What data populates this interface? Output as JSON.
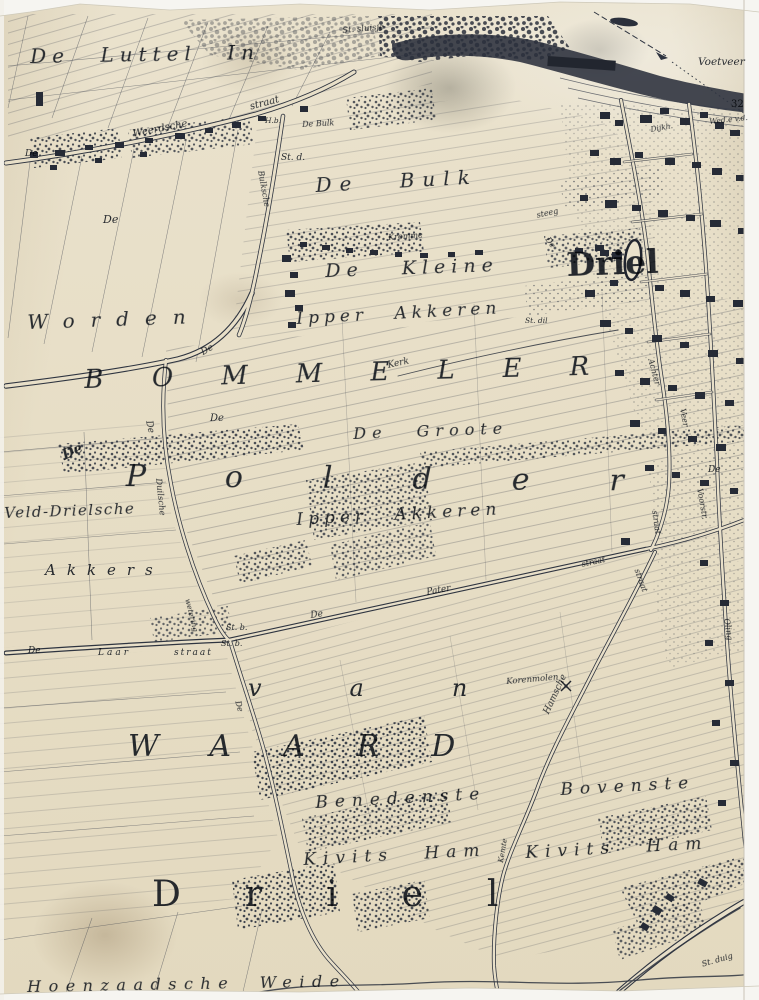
{
  "map": {
    "type": "historical-cadastral-map",
    "colors": {
      "paper": "#e8dfc8",
      "ink": "#2e3440",
      "frame": "#f6f5f1"
    },
    "labels": [
      {
        "id": "de-luttel-in",
        "t": "De Luttel In",
        "x": 30,
        "y": 46,
        "s": 20,
        "ls": 6,
        "ws": 18,
        "rot": -1
      },
      {
        "id": "st-sluisje",
        "t": "St. sluisje",
        "x": 342,
        "y": 27,
        "s": 8.5,
        "rot": -5
      },
      {
        "id": "voetveer",
        "t": "Voetveer",
        "x": 698,
        "y": 57,
        "s": 10.5
      },
      {
        "id": "peil-32",
        "t": "32",
        "x": 731,
        "y": 100,
        "s": 10,
        "cls": "upright"
      },
      {
        "id": "wed-vd",
        "t": "Wed.e v.d.",
        "x": 709,
        "y": 118,
        "s": 7.5,
        "rot": -6
      },
      {
        "id": "dijkh",
        "t": "Dijkh.",
        "x": 650,
        "y": 126,
        "s": 7.5,
        "rot": -10
      },
      {
        "id": "de-topleft",
        "t": "De",
        "x": 25,
        "y": 150,
        "s": 9
      },
      {
        "id": "weerdsche",
        "t": "Weerdsche",
        "x": 132,
        "y": 130,
        "s": 10,
        "rot": -11
      },
      {
        "id": "straat-top",
        "t": "straat",
        "x": 249,
        "y": 103,
        "s": 10,
        "rot": -15
      },
      {
        "id": "h-b",
        "t": "H.b.",
        "x": 265,
        "y": 117,
        "s": 7.5
      },
      {
        "id": "de-bulk-farm",
        "t": "De Bulk",
        "x": 302,
        "y": 121,
        "s": 8,
        "rot": -3
      },
      {
        "id": "st-d",
        "t": "St. d.",
        "x": 281,
        "y": 154,
        "s": 9
      },
      {
        "id": "bulksche-road",
        "t": "Bulksche",
        "x": 264,
        "y": 170,
        "s": 8,
        "rot": 80
      },
      {
        "id": "de-bulk",
        "t": "De Bulk",
        "x": 315,
        "y": 175,
        "s": 20,
        "ls": 8,
        "ws": 26,
        "rot": -3
      },
      {
        "id": "steeg",
        "t": "steeg",
        "x": 536,
        "y": 212,
        "s": 8,
        "rot": -12
      },
      {
        "id": "kromme",
        "t": "Kromme",
        "x": 388,
        "y": 234,
        "s": 8,
        "rot": -4
      },
      {
        "id": "de-road-driel",
        "t": "De",
        "x": 550,
        "y": 236,
        "s": 8,
        "rot": 55
      },
      {
        "id": "driel-town",
        "t": "Driel",
        "x": 566,
        "y": 248,
        "s": 33,
        "cls": "heavy",
        "rot": -2
      },
      {
        "id": "de-kleine",
        "t": "De Kleine",
        "x": 325,
        "y": 262,
        "s": 19,
        "ls": 6,
        "ws": 26,
        "rot": -2
      },
      {
        "id": "de-worden",
        "t": "De",
        "x": 103,
        "y": 214,
        "s": 11
      },
      {
        "id": "worden",
        "t": "Worden",
        "x": 27,
        "y": 312,
        "s": 20,
        "ls": 16,
        "rot": -2
      },
      {
        "id": "ipper-akkeren-1",
        "t": "Ipper Akkeren",
        "x": 296,
        "y": 311,
        "s": 17,
        "ls": 5,
        "ws": 16,
        "rot": -3
      },
      {
        "id": "st-dil",
        "t": "St. dil",
        "x": 525,
        "y": 317,
        "s": 7.5
      },
      {
        "id": "kerk-road",
        "t": "Kerk",
        "x": 387,
        "y": 362,
        "s": 9,
        "rot": -12
      },
      {
        "id": "bommeler",
        "t": "BOMMELER",
        "x": 84,
        "y": 367,
        "s": 26,
        "ls": 48,
        "rot": -1.5
      },
      {
        "id": "de-dike",
        "t": "De",
        "x": 200,
        "y": 350,
        "s": 9,
        "rot": -30
      },
      {
        "id": "de-small-1",
        "t": "De",
        "x": 210,
        "y": 414,
        "s": 10
      },
      {
        "id": "de-vert-1",
        "t": "De",
        "x": 152,
        "y": 420,
        "s": 9,
        "rot": 78
      },
      {
        "id": "de-groote",
        "t": "De Groote",
        "x": 353,
        "y": 426,
        "s": 16,
        "ls": 6,
        "ws": 18,
        "rot": -2
      },
      {
        "id": "de-polder",
        "t": "De",
        "x": 60,
        "y": 450,
        "s": 14,
        "rot": -25,
        "cls": "bold"
      },
      {
        "id": "polder",
        "t": "Polder",
        "x": 126,
        "y": 462,
        "s": 30,
        "ls": 80,
        "rot": 0.5
      },
      {
        "id": "de-voorn",
        "t": "De",
        "x": 708,
        "y": 466,
        "s": 9
      },
      {
        "id": "voorstr",
        "t": "Voorstr.",
        "x": 703,
        "y": 488,
        "s": 8,
        "rot": 80
      },
      {
        "id": "veld-drielsche",
        "t": "Veld-Drielsche",
        "x": 4,
        "y": 506,
        "s": 15,
        "ls": 1.5,
        "rot": -2
      },
      {
        "id": "duilsche-road",
        "t": "Duilsche",
        "x": 162,
        "y": 478,
        "s": 8.5,
        "rot": 84
      },
      {
        "id": "ipper-akkeren-2",
        "t": "Ipper Akkeren",
        "x": 296,
        "y": 512,
        "s": 17,
        "ls": 5,
        "ws": 16,
        "rot": -3
      },
      {
        "id": "akkers",
        "t": "Akkers",
        "x": 45,
        "y": 563,
        "s": 15,
        "ls": 11
      },
      {
        "id": "straat-mid",
        "t": "straat",
        "x": 581,
        "y": 561,
        "s": 8,
        "rot": -12
      },
      {
        "id": "achter-road",
        "t": "Achter",
        "x": 654,
        "y": 358,
        "s": 8,
        "rot": 75
      },
      {
        "id": "veer-road",
        "t": "Veer",
        "x": 686,
        "y": 408,
        "s": 8,
        "rot": 80
      },
      {
        "id": "straat-f1",
        "t": "straat",
        "x": 658,
        "y": 510,
        "s": 8,
        "rot": 82
      },
      {
        "id": "straat-f1b",
        "t": "straat",
        "x": 640,
        "y": 568,
        "s": 8,
        "rot": 70
      },
      {
        "id": "oling-road",
        "t": "Oling",
        "x": 730,
        "y": 618,
        "s": 8,
        "rot": 82
      },
      {
        "id": "de-pater-de",
        "t": "De",
        "x": 310,
        "y": 612,
        "s": 9,
        "rot": -8
      },
      {
        "id": "pater",
        "t": "Pater",
        "x": 426,
        "y": 589,
        "s": 9,
        "rot": -10
      },
      {
        "id": "wetering",
        "t": "wetering",
        "x": 191,
        "y": 598,
        "s": 7.5,
        "rot": 76
      },
      {
        "id": "st-b-1",
        "t": "St. b.",
        "x": 226,
        "y": 624,
        "s": 8
      },
      {
        "id": "st-b-2",
        "t": "St. b.",
        "x": 221,
        "y": 640,
        "s": 8
      },
      {
        "id": "de-laar",
        "t": "De",
        "x": 28,
        "y": 647,
        "s": 9
      },
      {
        "id": "laar",
        "t": "Laar",
        "x": 98,
        "y": 649,
        "s": 9,
        "ls": 3
      },
      {
        "id": "laar-straat",
        "t": "straat",
        "x": 174,
        "y": 649,
        "s": 9,
        "ls": 2
      },
      {
        "id": "van",
        "t": "van",
        "x": 248,
        "y": 676,
        "s": 24,
        "ls": 88
      },
      {
        "id": "de-vert-2",
        "t": "De",
        "x": 241,
        "y": 700,
        "s": 8,
        "rot": 75
      },
      {
        "id": "korenmolen",
        "t": "Korenmolen",
        "x": 506,
        "y": 678,
        "s": 8.5,
        "rot": -5
      },
      {
        "id": "hamsche-road",
        "t": "Hamsche",
        "x": 543,
        "y": 712,
        "s": 9,
        "rot": -65
      },
      {
        "id": "waard",
        "t": "WAARD",
        "x": 128,
        "y": 732,
        "s": 30,
        "ls": 52,
        "rot": 0
      },
      {
        "id": "benedenste",
        "t": "Benedenste",
        "x": 315,
        "y": 795,
        "s": 17,
        "ls": 7,
        "rot": -3
      },
      {
        "id": "bovenste",
        "t": "Bovenste",
        "x": 560,
        "y": 782,
        "s": 17,
        "ls": 7,
        "rot": -3
      },
      {
        "id": "kivits-ham-1",
        "t": "Kivits Ham",
        "x": 303,
        "y": 852,
        "s": 17,
        "ls": 7,
        "ws": 18,
        "rot": -3
      },
      {
        "id": "kivits-ham-2",
        "t": "Kivits Ham",
        "x": 525,
        "y": 845,
        "s": 17,
        "ls": 7,
        "ws": 18,
        "rot": -3
      },
      {
        "id": "kemte-road",
        "t": "Kemte",
        "x": 497,
        "y": 862,
        "s": 7.5,
        "rot": -80
      },
      {
        "id": "driel-south",
        "t": "Driel",
        "x": 152,
        "y": 877,
        "s": 36,
        "ls": 64,
        "cls": "upright"
      },
      {
        "id": "st-duig",
        "t": "St. duig",
        "x": 701,
        "y": 961,
        "s": 8,
        "rot": -16
      },
      {
        "id": "hoenzaadsche-weide",
        "t": "Hoenzaadsche Weide",
        "x": 27,
        "y": 979,
        "s": 16,
        "ls": 7.5,
        "ws": 12,
        "rot": -1
      }
    ]
  }
}
